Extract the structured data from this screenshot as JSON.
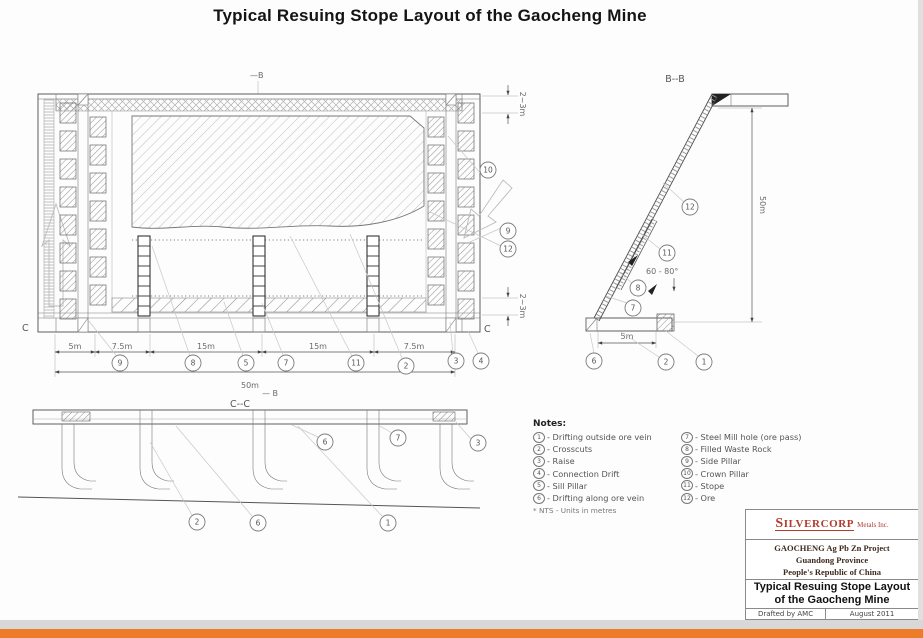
{
  "page": {
    "title": "Typical Resuing Stope Layout of the Gaocheng  Mine"
  },
  "plan": {
    "marker_top": "—B",
    "marker_bottom": "— B",
    "c_left": "C",
    "c_right": "C",
    "dims": {
      "seg1": "5m",
      "seg2": "7.5m",
      "seg3": "15m",
      "seg4": "15m",
      "seg5": "7.5m",
      "total": "50m",
      "crown": "2~3m",
      "sill": "2~3m"
    },
    "callouts": {
      "side_pillar": "9",
      "filled_waste": "8",
      "sill_pillar": "5",
      "ore_pass": "7",
      "stope": "11",
      "crosscuts": "2",
      "raise": "3",
      "connection": "4",
      "crown_pillar": "10",
      "side_pillar_r": "9",
      "ore": "12"
    }
  },
  "section_bb": {
    "title": "B--B",
    "height_dim": "50m",
    "width_dim": "5m",
    "angle": "60 - 80°",
    "callouts": {
      "ore": "12",
      "stope": "11",
      "filled_waste": "8",
      "ore_pass": "7",
      "drift_along": "6",
      "crosscuts": "2",
      "drift_outside": "1"
    }
  },
  "section_cc": {
    "title": "C--C",
    "callouts": {
      "drift_along_top": "6",
      "ore_pass": "7",
      "raise": "3",
      "crosscuts": "2",
      "drift_along_bottom": "6",
      "drift_outside": "1"
    }
  },
  "notes": {
    "heading": "Notes:",
    "left": [
      {
        "n": "1",
        "text": "- Drifting outside ore vein"
      },
      {
        "n": "2",
        "text": "- Crosscuts"
      },
      {
        "n": "3",
        "text": "- Raise"
      },
      {
        "n": "4",
        "text": "- Connection Drift"
      },
      {
        "n": "5",
        "text": "- Sill Pillar"
      },
      {
        "n": "6",
        "text": "- Drifting along ore vein"
      }
    ],
    "right": [
      {
        "n": "7",
        "text": "- Steel Mill hole (ore pass)"
      },
      {
        "n": "8",
        "text": "- Filled Waste Rock"
      },
      {
        "n": "9",
        "text": "- Side Pillar"
      },
      {
        "n": "10",
        "text": "- Crown Pillar"
      },
      {
        "n": "11",
        "text": "- Stope"
      },
      {
        "n": "12",
        "text": "- Ore"
      }
    ],
    "footnote": "* NTS - Units in metres"
  },
  "title_block": {
    "logo": "SILVERCORP",
    "logo_suffix": "Metals Inc.",
    "line1": "GAOCHENG Ag Pb Zn Project",
    "line2": "Guandong Province",
    "line3": "People's Republic of China",
    "drawing_title_line1": "Typical Resuing Stope Layout",
    "drawing_title_line2": "of the Gaocheng Mine",
    "drafted_by": "Drafted by AMC",
    "date": "August 2011"
  },
  "colors": {
    "accent_orange": "#ee7b28",
    "logo_red": "#b23b2e"
  }
}
